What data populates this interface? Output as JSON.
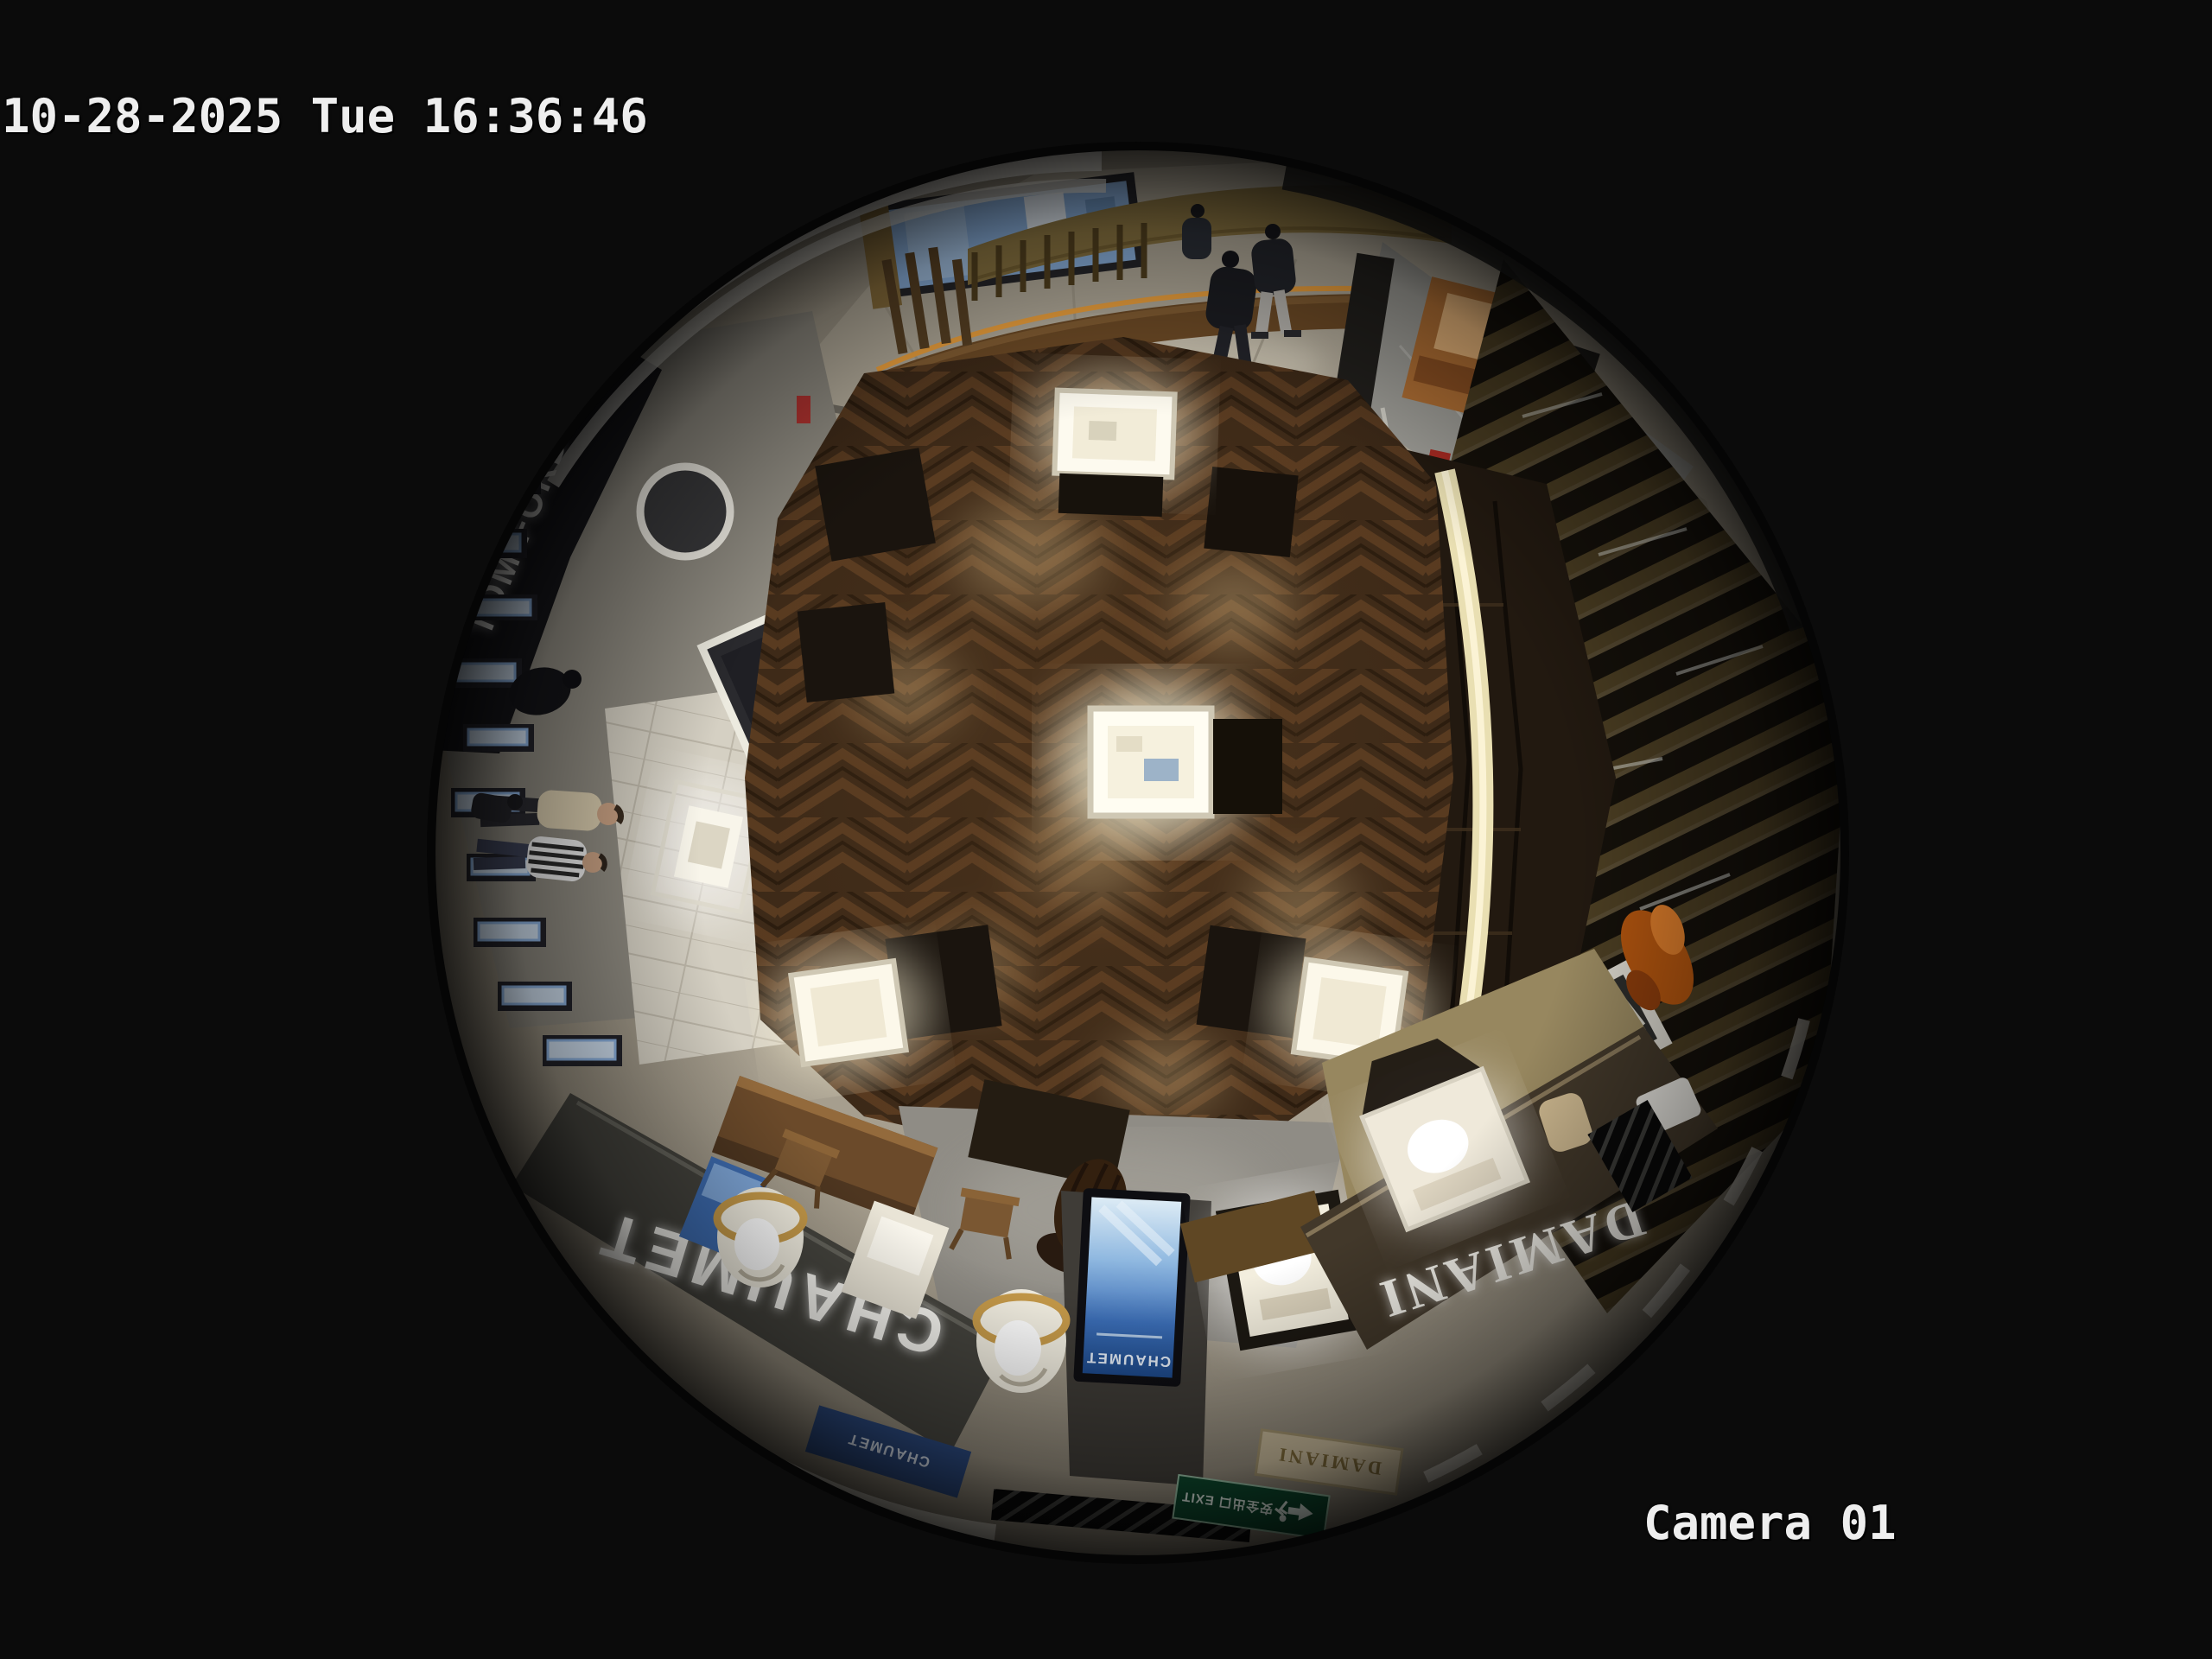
{
  "osd": {
    "timestamp": "10-28-2025 Tue 16:36:46",
    "camera_label": "Camera 01",
    "text_color": "#eeeeee"
  },
  "fisheye": {
    "scene": "Overhead 360-degree fisheye view of a luxury jewelry retail floor: dark herringbone wood center with illuminated glass vitrines, light marble mall corridor at top, cosmetics counters at left, wood-slat screen wall at right, boutique fascias at bottom",
    "signs": {
      "chaumet_fascia": "CHAUMET",
      "damiani_fascia": "DAMIANI",
      "tom_ford_fascia": "TOM FORD",
      "tf_logo_panel": "TF",
      "chaumet_kiosk_screen": "CHAUMET",
      "chaumet_entrance_banner": "CHAUMET",
      "damiani_directory_sign": "DAMIANI",
      "exit_sign": "安全出口 EXIT",
      "exit_sign_icons": "running-man, left-arrow"
    },
    "colors": {
      "background": "#0b0b0b",
      "wood_floor": "#3b2817",
      "wood_highlight": "#6b4a28",
      "marble_walkway": "#b3ab9b",
      "ceiling_band": "#e9e6dd",
      "chaumet_fascia": "#45443e",
      "damiani_fascia": "#42382a",
      "tom_ford_fascia": "#16161a",
      "kiosk_screen_blue": "#3a6cb4",
      "exit_green": "#0d4a2e",
      "gold_wall": "#8c7642",
      "led_amber": "#f2a43e",
      "vitrine_light": "#fdf9ec"
    },
    "people": [
      {
        "area": "mall corridor top",
        "desc": "shopper walking, dark jacket and trousers"
      },
      {
        "area": "mall corridor top",
        "desc": "shopper walking, dark top with light gray pants"
      },
      {
        "area": "mall corridor top",
        "desc": "shopper partially hidden near storefront"
      },
      {
        "area": "left counter",
        "desc": "customer in black at lit cosmetics counter"
      },
      {
        "area": "left walkway",
        "desc": "staff in cream top with dark trousers"
      },
      {
        "area": "left walkway",
        "desc": "customer in black-and-white striped shirt"
      },
      {
        "area": "left walkway",
        "desc": "shopper in dark coat near counters"
      },
      {
        "area": "bottom center lounge",
        "desc": "seated customer with long dark hair"
      }
    ],
    "fixtures": [
      "herringbone wood floor",
      "illuminated glass vitrines",
      "cylindrical display cases with gold rims",
      "curved gold reception wall with wooden slats",
      "wood-slat screen wall",
      "digital advertising kiosk",
      "round illuminated mirror",
      "green emergency exit sign",
      "glass balustrade panels"
    ]
  }
}
